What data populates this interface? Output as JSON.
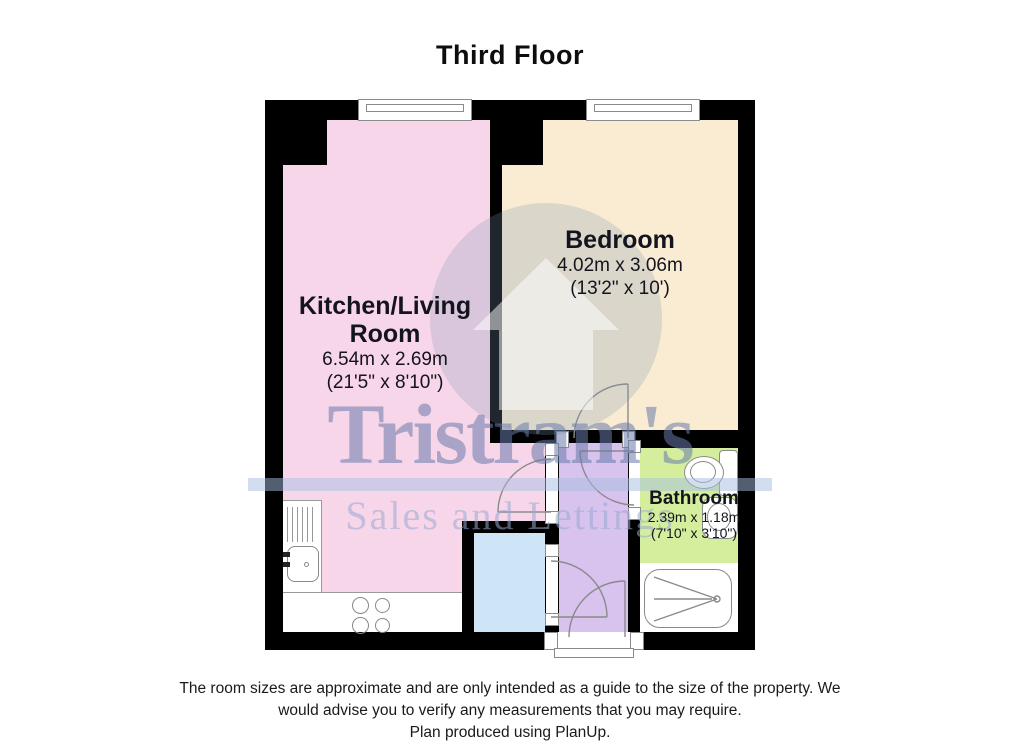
{
  "title": "Third Floor",
  "plan": {
    "wall_color": "#000000",
    "rooms": [
      {
        "name_line1": "Kitchen/Living",
        "name_line2": "Room",
        "dims_metric": "6.54m x 2.69m",
        "dims_imperial": "(21'5\" x 8'10\")",
        "color": "#f8d6ea"
      },
      {
        "name": "Bedroom",
        "dims_metric": "4.02m x 3.06m",
        "dims_imperial": "(13'2\" x 10')",
        "color": "#faecd2"
      },
      {
        "name": "Bathroom",
        "dims_metric": "2.39m x 1.18m",
        "dims_imperial": "(7'10\" x 3'10\")",
        "color": "#d5ee9e"
      }
    ],
    "hallway_color": "#d8c3ee",
    "storage_color": "#cde5f6"
  },
  "watermark": {
    "brand": "Tristram's",
    "tagline": "Sales and Lettings"
  },
  "footer": {
    "line1": "The room sizes are approximate and are only intended as a guide to the size of the property. We",
    "line2": "would advise you to verify any measurements that you may require.",
    "line3": "Plan produced using PlanUp."
  }
}
